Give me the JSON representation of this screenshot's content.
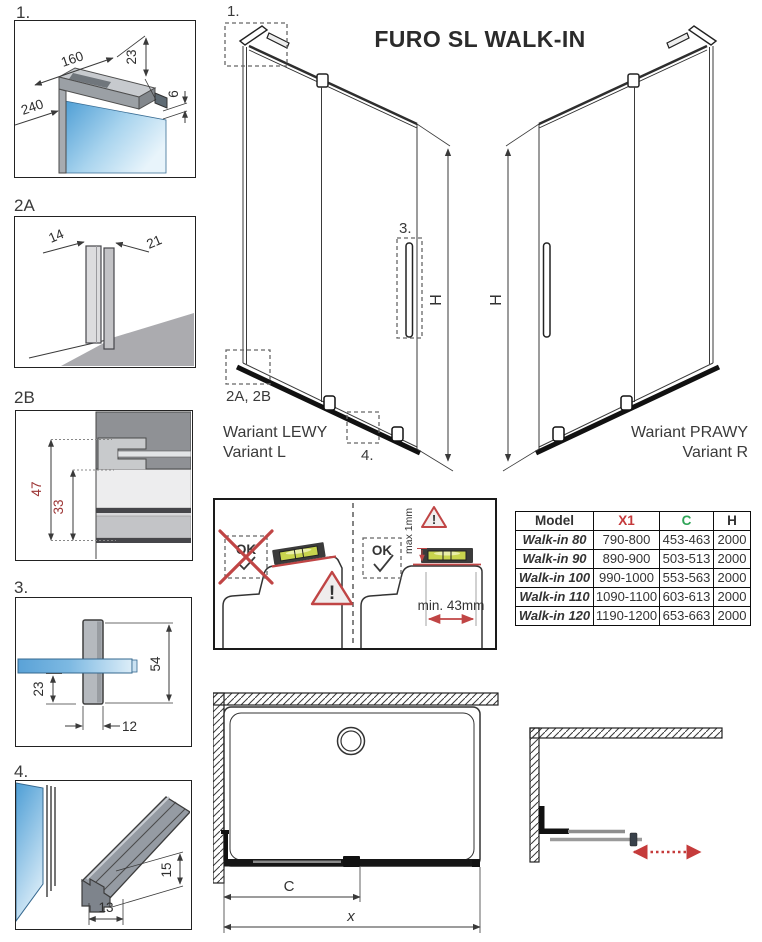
{
  "title": "FURO SL WALK-IN",
  "details": {
    "p1": {
      "label": "1.",
      "dim_arm_length": "160",
      "dim_arm_height": "23",
      "dim_depth": "240",
      "dim_gap": "6"
    },
    "p2a": {
      "label": "2A",
      "dim_front": "14",
      "dim_side": "21"
    },
    "p2b": {
      "label": "2B",
      "dim_total": "47",
      "dim_inner": "33"
    },
    "p3": {
      "label": "3.",
      "dim_height": "54",
      "dim_offset": "23",
      "dim_width": "12"
    },
    "p4": {
      "label": "4.",
      "dim_width": "13",
      "dim_height": "15"
    }
  },
  "variant_left": {
    "marker_1": "1.",
    "marker_3": "3.",
    "marker_2ab": "2A, 2B",
    "marker_4": "4.",
    "h_label": "H",
    "caption_pl": "Wariant LEWY",
    "caption_en": "Variant L"
  },
  "variant_right": {
    "h_label": "H",
    "caption_pl": "Wariant PRAWY",
    "caption_en": "Variant R"
  },
  "level_guide": {
    "wrong_ok": "OK",
    "correct_ok": "OK",
    "max_gap": "max 1mm",
    "min_width": "min. 43mm",
    "warning_mark": "!"
  },
  "size_table": {
    "col_model": "Model",
    "col_x1": "X1",
    "col_c": "C",
    "col_h": "H",
    "rows": [
      {
        "model": "Walk-in 80",
        "x1": "790-800",
        "c": "453-463",
        "h": "2000"
      },
      {
        "model": "Walk-in 90",
        "x1": "890-900",
        "c": "503-513",
        "h": "2000"
      },
      {
        "model": "Walk-in 100",
        "x1": "990-1000",
        "c": "553-563",
        "h": "2000"
      },
      {
        "model": "Walk-in 110",
        "x1": "1090-1100",
        "c": "603-613",
        "h": "2000"
      },
      {
        "model": "Walk-in 120",
        "x1": "1190-1200",
        "c": "653-663",
        "h": "2000"
      }
    ]
  },
  "tray_plan": {
    "inner_width_label": "C",
    "total_width_label": "x"
  },
  "colors": {
    "accent_red": "#c04545",
    "accent_green": "#2fa457",
    "dim_red": "#9c3434",
    "glass_blue": "#4e9ed5",
    "level_vial": "#c8d44e",
    "line_dark": "#3a3a3a"
  }
}
